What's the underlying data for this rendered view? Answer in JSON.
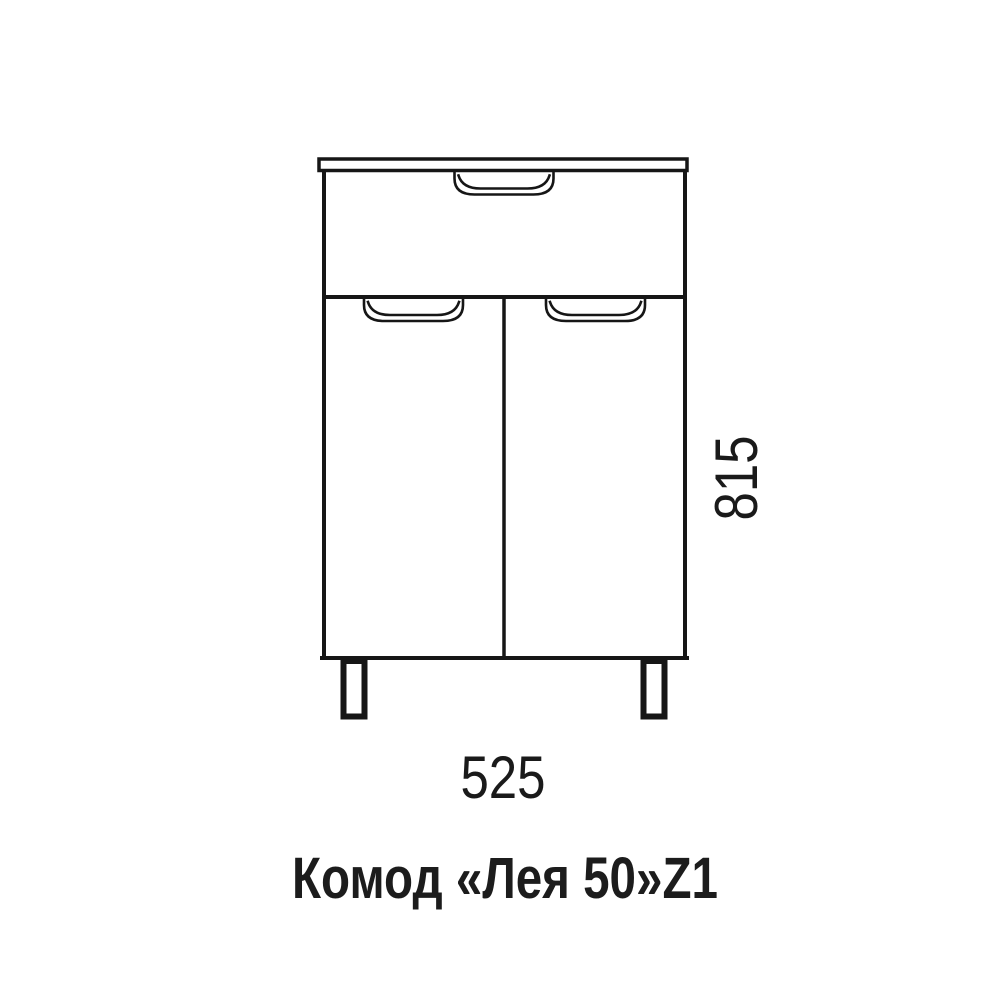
{
  "page": {
    "background_color": "#ffffff",
    "line_color": "#161616"
  },
  "drawing": {
    "product_title": "Комод «Лея 50»Z1",
    "dimensions": {
      "width_mm": "525",
      "height_mm": "815"
    }
  }
}
